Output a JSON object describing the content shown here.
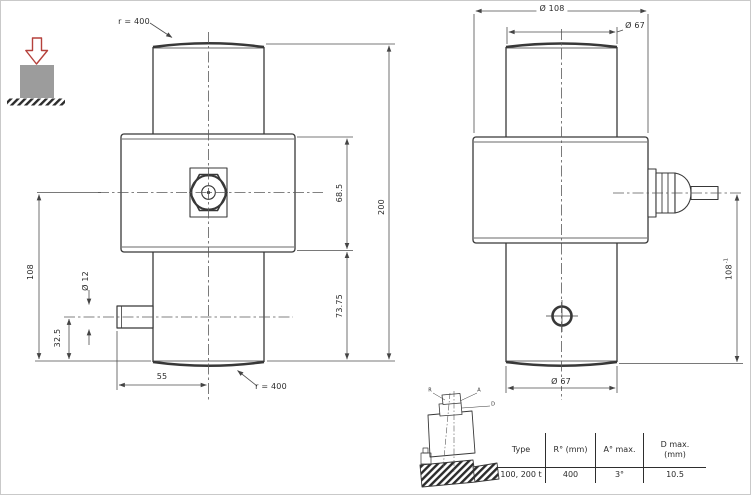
{
  "front_view": {
    "radius_top": "r = 400",
    "radius_bottom": "r = 400",
    "dim_body_height": "68.5",
    "dim_total_height": "200",
    "dim_lower_height": "73.75",
    "dim_connector_height": "108",
    "dim_pin_diameter": "Ø 12",
    "dim_pin_height": "32.5",
    "dim_pin_offset": "55"
  },
  "side_view": {
    "dim_body_diameter": "Ø 108",
    "dim_top_diameter": "Ø 67",
    "dim_bottom_diameter": "Ø 67",
    "dim_gland_height": "108",
    "dim_gland_tolerance": "-1"
  },
  "tilt_diagram": {
    "label_r": "R",
    "label_a": "A",
    "label_d": "D"
  },
  "spec_table": {
    "headers": [
      "Type",
      "R° (mm)",
      "A° max.",
      "D max.\n(mm)"
    ],
    "row": [
      "100, 200 t",
      "400",
      "3°",
      "10.5"
    ]
  },
  "colors": {
    "line": "#383838",
    "dimension": "#4d4d4d",
    "load_arrow_red": "#b5413c",
    "block_gray": "#9c9c9c"
  }
}
